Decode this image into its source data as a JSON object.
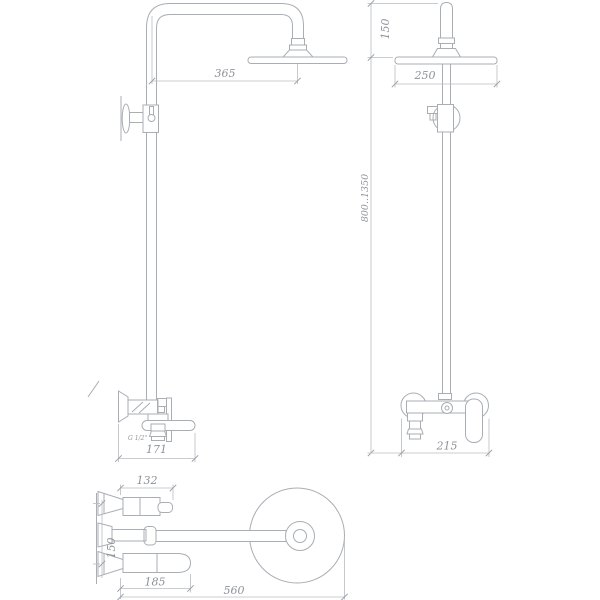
{
  "drawing": {
    "subject": "Technical dimension drawing of a wall-mounted shower column (rain head, riser pipe, wall mixer) in three orthographic views",
    "colors": {
      "background": "#ffffff",
      "line": "#a9aeb4",
      "dimension_line": "#b7bbc1",
      "text": "#8e9299"
    },
    "dims": {
      "side_arm_reach": "365",
      "side_mixer_width": "171",
      "side_thread": "G 1/2\"",
      "front_head_drop": "150",
      "front_head_diameter": "250",
      "front_column_height": "800..1350",
      "front_mixer_width": "215",
      "top_body_length": "132",
      "top_ports_spacing": "150",
      "top_handle_reach": "185",
      "top_total_reach": "560"
    }
  }
}
